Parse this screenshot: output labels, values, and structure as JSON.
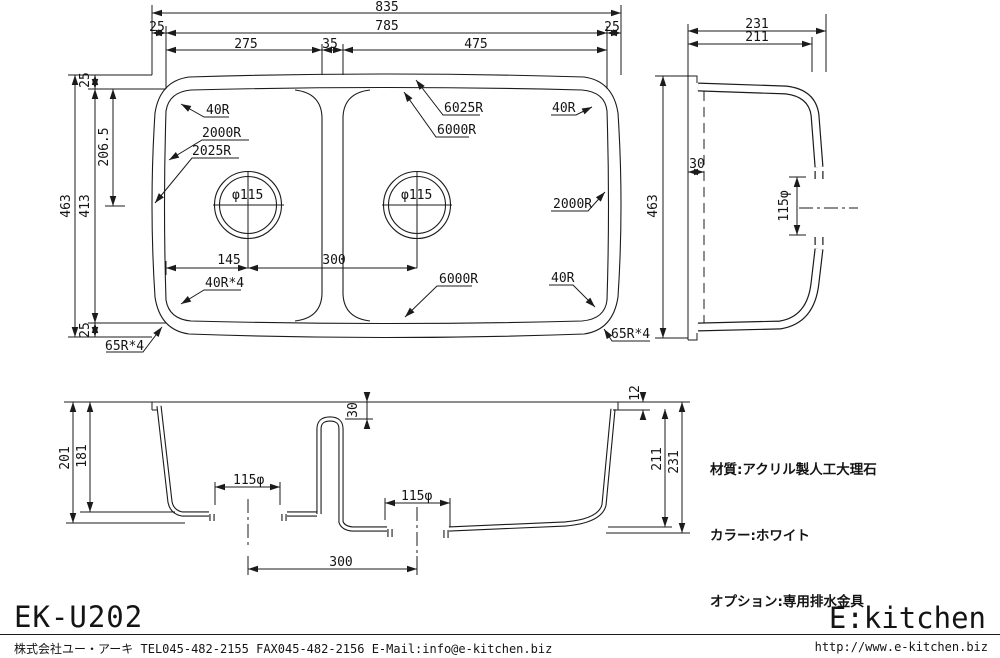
{
  "plan": {
    "total_width": "835",
    "margin_left": "25",
    "inner_width": "785",
    "margin_right": "25",
    "left_bowl_width": "275",
    "divider_width": "35",
    "right_bowl_width": "475",
    "total_height": "463",
    "margin_top": "25",
    "inner_height": "413",
    "margin_bottom": "25",
    "drain_center_offset": "206.5",
    "drain_left_offset": "145",
    "drain_pitch": "300",
    "corner_tl": "40R",
    "left_edge_inner_r": "2000R",
    "left_edge_outer_r": "2025R",
    "top_edge_outer_r": "6025R",
    "top_edge_inner_r": "6000R",
    "corner_tr": "40R",
    "right_edge_inner_r": "2000R",
    "drain_left_dia": "φ115",
    "drain_right_dia": "φ115",
    "corner_bl": "40R*4",
    "bottom_edge_inner_r": "6000R",
    "corner_br": "40R",
    "outer_corner_bl": "65R*4",
    "outer_corner_br": "65R*4"
  },
  "side": {
    "total_depth": "231",
    "inner_depth": "211",
    "total_height": "463",
    "flange_offset": "30",
    "drain_dia": "115φ"
  },
  "front": {
    "left_depth_outer": "201",
    "left_depth_inner": "181",
    "divider_drop": "30",
    "rim_edge": "12",
    "right_depth_inner": "211",
    "right_depth_outer": "231",
    "drain_left_dia": "115φ",
    "drain_right_dia": "115φ",
    "drain_pitch": "300"
  },
  "specs": {
    "material": "材質:アクリル製人工大理石",
    "color": "カラー:ホワイト",
    "option": "オプション:専用排水金具"
  },
  "footer": {
    "model": "EK-U202",
    "brand": "E:kitchen",
    "company": "株式会社ユー・アーキ TEL045-482-2155 FAX045-482-2156 E-Mail:info@e-kitchen.biz",
    "url": "http://www.e-kitchen.biz"
  }
}
